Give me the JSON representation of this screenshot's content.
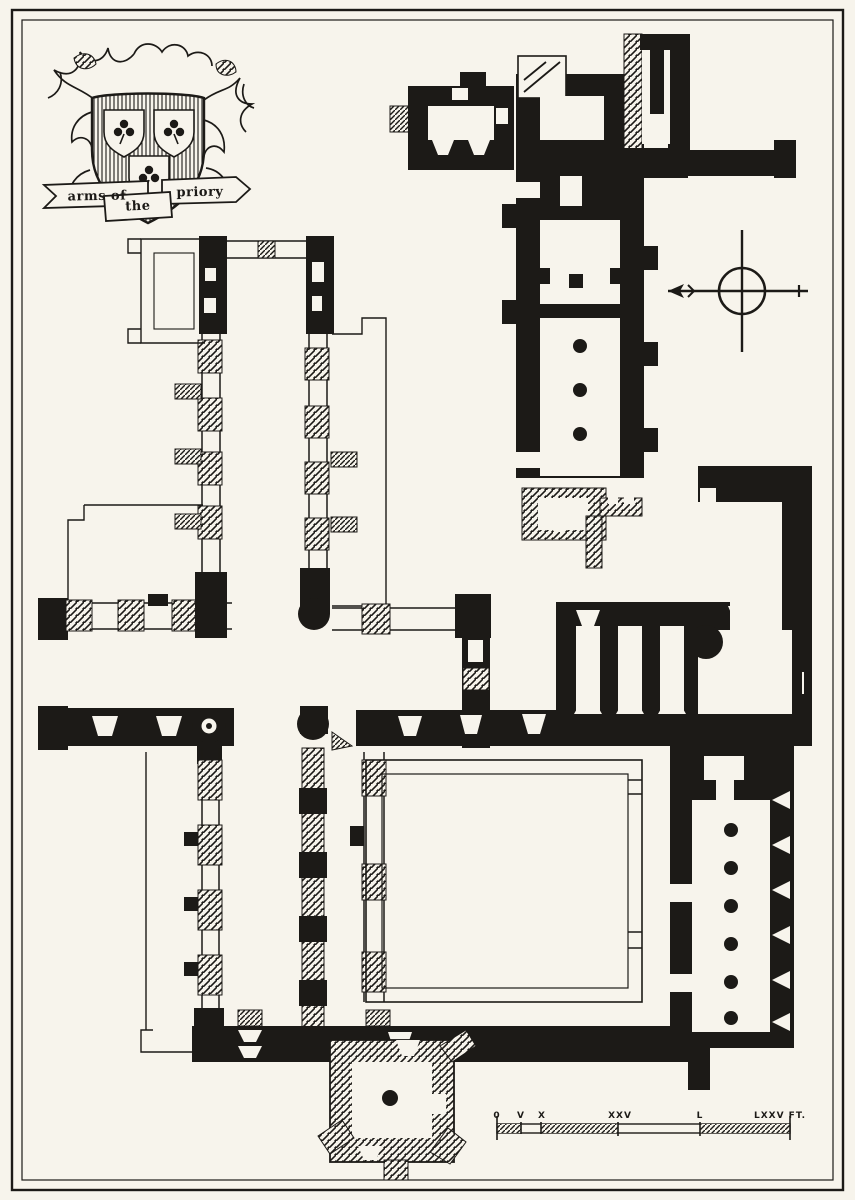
{
  "colors": {
    "paper": "#f7f4ec",
    "ink": "#1c1a17"
  },
  "heraldry": {
    "banner_left": "arms of",
    "banner_center": "the",
    "banner_right": "priory",
    "shield_charges": "three escutcheons each with a trefoil"
  },
  "compass": {
    "icon": "north-arrow-compass-icon",
    "arrow_points": "left"
  },
  "scale_bar": {
    "labels": [
      "0",
      "V",
      "X",
      "XXV",
      "L",
      "LXXV FT."
    ]
  }
}
